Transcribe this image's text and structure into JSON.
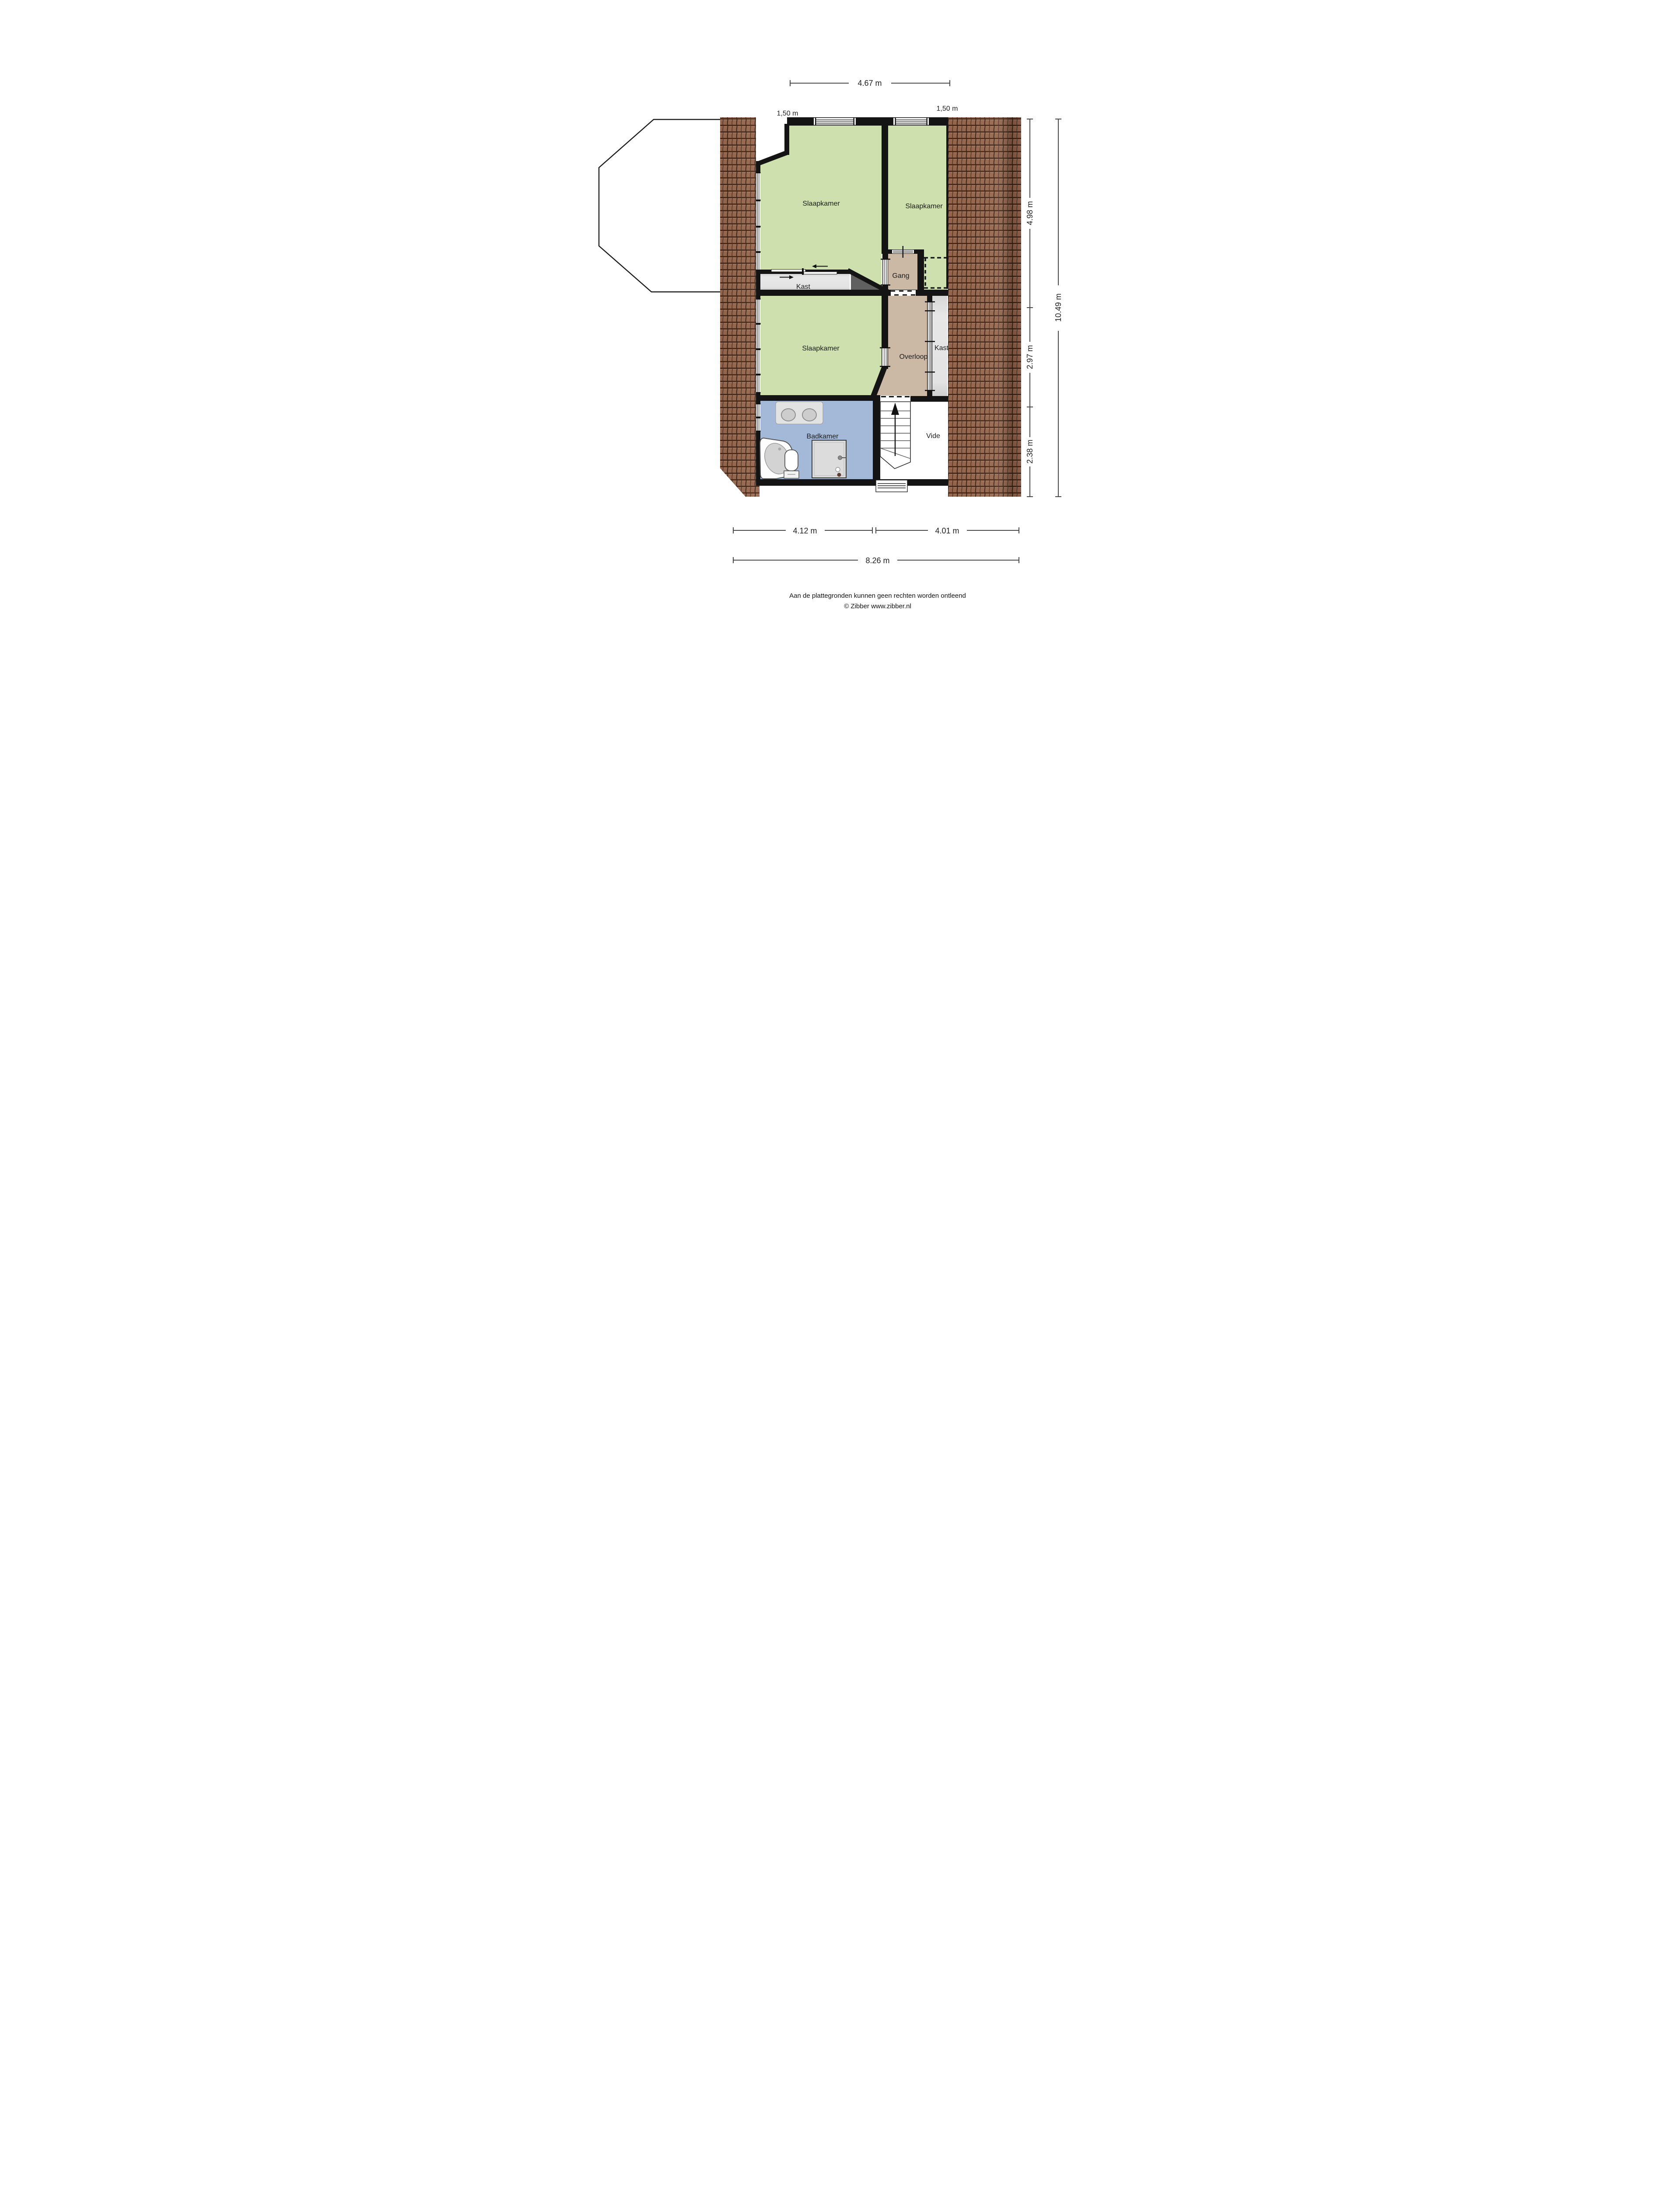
{
  "plan": {
    "rooms": {
      "slaapkamer_top_left": "Slaapkamer",
      "slaapkamer_top_right": "Slaapkamer",
      "slaapkamer_middle": "Slaapkamer",
      "gang": "Gang",
      "kast_upper": "Kast",
      "kast_right": "Kast",
      "overloop": "Overloop",
      "badkamer": "Badkamer",
      "vide": "Vide"
    },
    "dimensions": {
      "top_width": "4.67 m",
      "top_offset_left": "1,50 m",
      "top_offset_right": "1,50 m",
      "right_upper": "4.98 m",
      "right_middle": "2.97 m",
      "right_lower": "2.38 m",
      "right_total": "10.49 m",
      "bottom_left": "4.12 m",
      "bottom_right": "4.01 m",
      "bottom_total": "8.26 m"
    },
    "colors": {
      "bedroom": "#cde0ae",
      "hallway": "#cbb9a6",
      "closet": "#e3e3e3",
      "bathroom": "#a4b8d7",
      "vide": "#ffffff",
      "wedge": "#606060",
      "wall": "#141414",
      "roof_base": "#96674f",
      "roof_dark": "#4c2b1b"
    }
  },
  "footer": {
    "disclaimer": "Aan de plattegronden kunnen geen rechten worden ontleend",
    "credit": "© Zibber www.zibber.nl"
  }
}
